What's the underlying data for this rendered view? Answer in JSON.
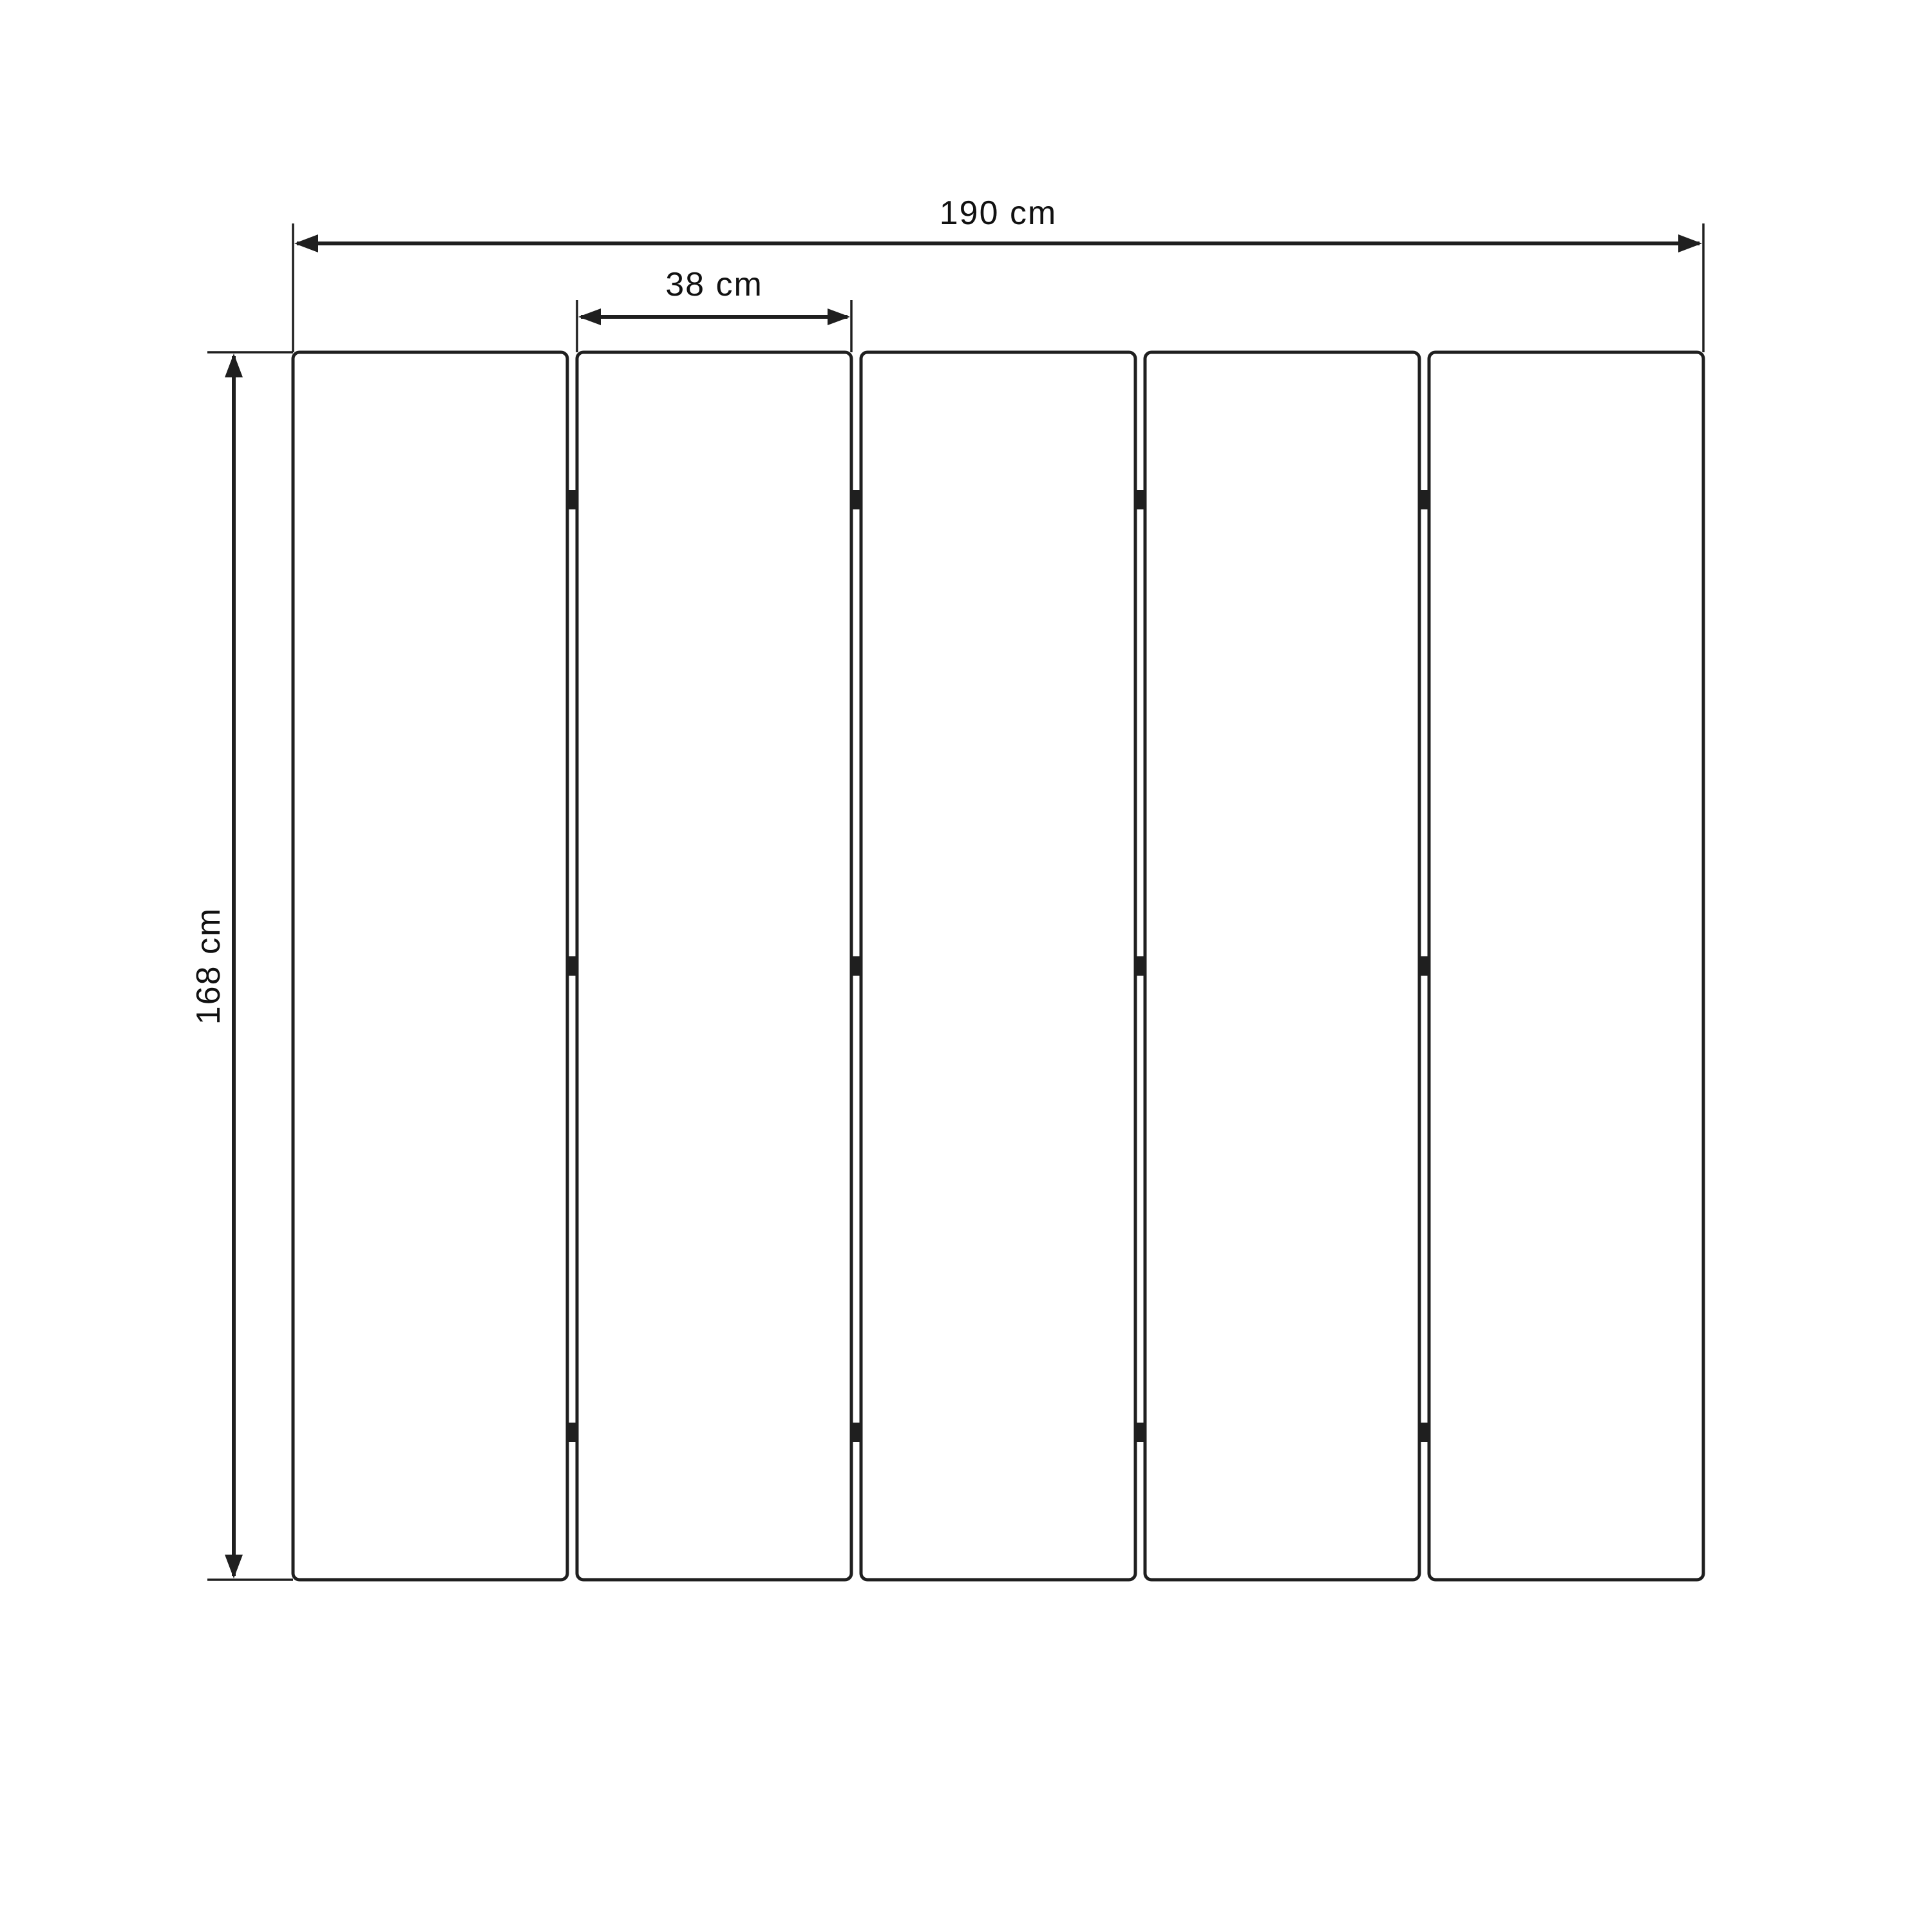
{
  "diagram": {
    "kind": "technical-dimension-drawing",
    "subject": "five-panel folding screen room divider, front elevation",
    "background_color": "#ffffff",
    "line_color": "#1f1f1f",
    "panels": {
      "count": 5,
      "hinge_rows": 3
    },
    "dimensions": {
      "total_width": {
        "label": "190 cm",
        "value": 190,
        "unit": "cm",
        "orientation": "horizontal"
      },
      "panel_width": {
        "label": "38 cm",
        "value": 38,
        "unit": "cm",
        "orientation": "horizontal"
      },
      "height": {
        "label": "168 cm",
        "value": 168,
        "unit": "cm",
        "orientation": "vertical"
      }
    }
  }
}
